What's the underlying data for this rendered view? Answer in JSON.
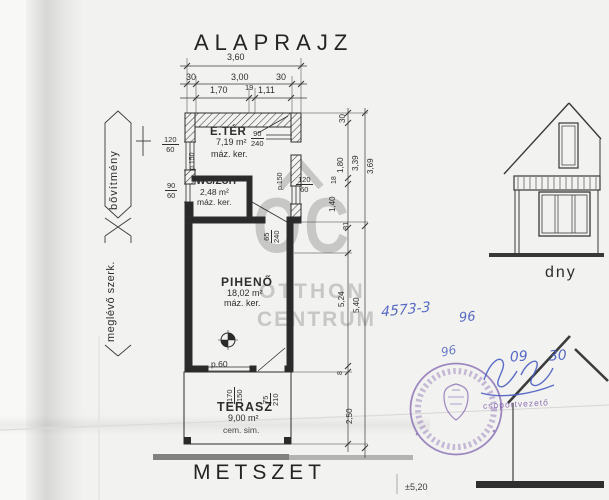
{
  "titles": {
    "plan": "ALAPRAJZ",
    "section": "METSZET",
    "elevation_orientation": "dny"
  },
  "watermark": {
    "monogram": "OC",
    "word1": "OTTHON",
    "word2": "CENTRUM"
  },
  "side_labels": {
    "extension": "bővítmény",
    "existing": "meglévő szerk."
  },
  "rooms": {
    "eter": {
      "name": "E.TÉR",
      "area": "7,19 m²",
      "finish": "máz. ker."
    },
    "wc": {
      "name": "WC/ZUH",
      "area": "2,48 m²",
      "finish": "máz. ker."
    },
    "piheno": {
      "name": "PIHENŐ",
      "area": "18,02 m²",
      "finish": "máz. ker."
    },
    "terasz": {
      "name": "TERASZ",
      "area": "9,00 m²",
      "finish": "cem. sim."
    }
  },
  "plan_notes": {
    "p60": "p.60",
    "p150_left": "p.150",
    "p150_right": "p.150"
  },
  "openings": {
    "door_eter": {
      "w": "90",
      "h": "240"
    },
    "window_eter_left": {
      "w": "120",
      "h": "60"
    },
    "window_wc_left": {
      "w": "90",
      "h": "60"
    },
    "window_right": {
      "w": "120",
      "h": "60"
    },
    "door_internal": {
      "w": "65",
      "h": "240"
    },
    "window_terrace": {
      "w": "170",
      "h": "150"
    },
    "door_terrace": {
      "w": "75",
      "h": "210"
    }
  },
  "dims_top": {
    "total": "3,60",
    "row2": [
      "30",
      "3,00",
      "30"
    ],
    "row3": [
      "1,70",
      "19",
      "1,11"
    ]
  },
  "dims_right": {
    "seg_30": "30",
    "seg_180": "1,80",
    "seg_18": "18",
    "seg_140": "1,40",
    "seg_81": "81",
    "sub_339": "3,39",
    "sub_369": "3,69",
    "sub_524": "5,24",
    "total_540": "5,40",
    "seg_8": "8",
    "seg_250": "2,50"
  },
  "handwriting": {
    "doc_no": "4573-3",
    "num_96a": "96",
    "num_96b": "96",
    "num_09": "09",
    "num_30": "30"
  },
  "stamp": {
    "role": "csoportvezető"
  },
  "levels": {
    "section_level": "±5,20"
  },
  "colors": {
    "ink": "#2e2e2e",
    "paper": "#f2f2f0",
    "watermark": "#c7c7c5",
    "handwriting_blue": "#4a5ec2",
    "stamp_purple": "#7d5fad"
  }
}
